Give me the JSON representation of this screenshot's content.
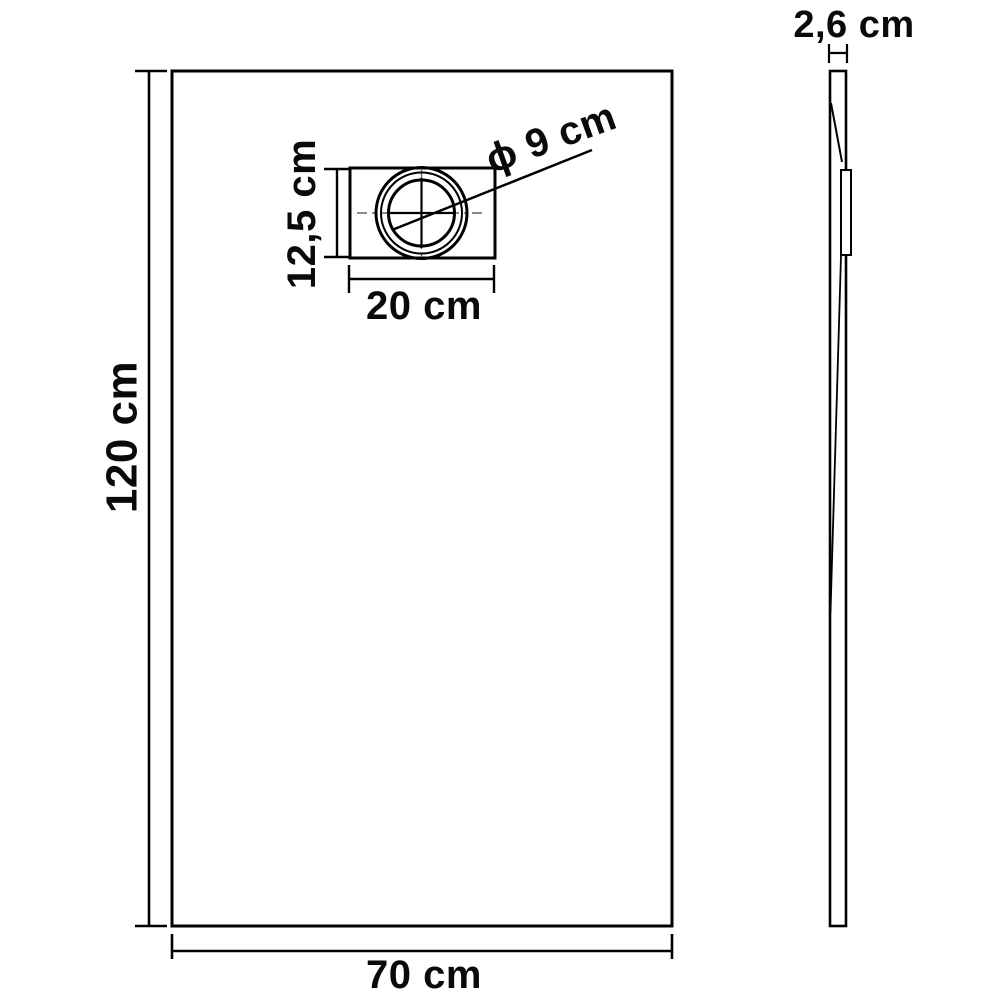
{
  "drawing": {
    "front_view": {
      "height_label": "120 cm",
      "width_label": "70 cm",
      "height_cm": 120,
      "width_cm": 70
    },
    "drain_detail": {
      "box_height_label": "12,5 cm",
      "box_width_label": "20 cm",
      "diameter_label": "ϕ 9 cm",
      "box_height_cm": 12.5,
      "box_width_cm": 20,
      "diameter_cm": 9
    },
    "side_view": {
      "thickness_label": "2,6 cm",
      "thickness_cm": 2.6
    },
    "colors": {
      "line": "#000000",
      "background": "#ffffff",
      "centerline": "#666666"
    }
  }
}
